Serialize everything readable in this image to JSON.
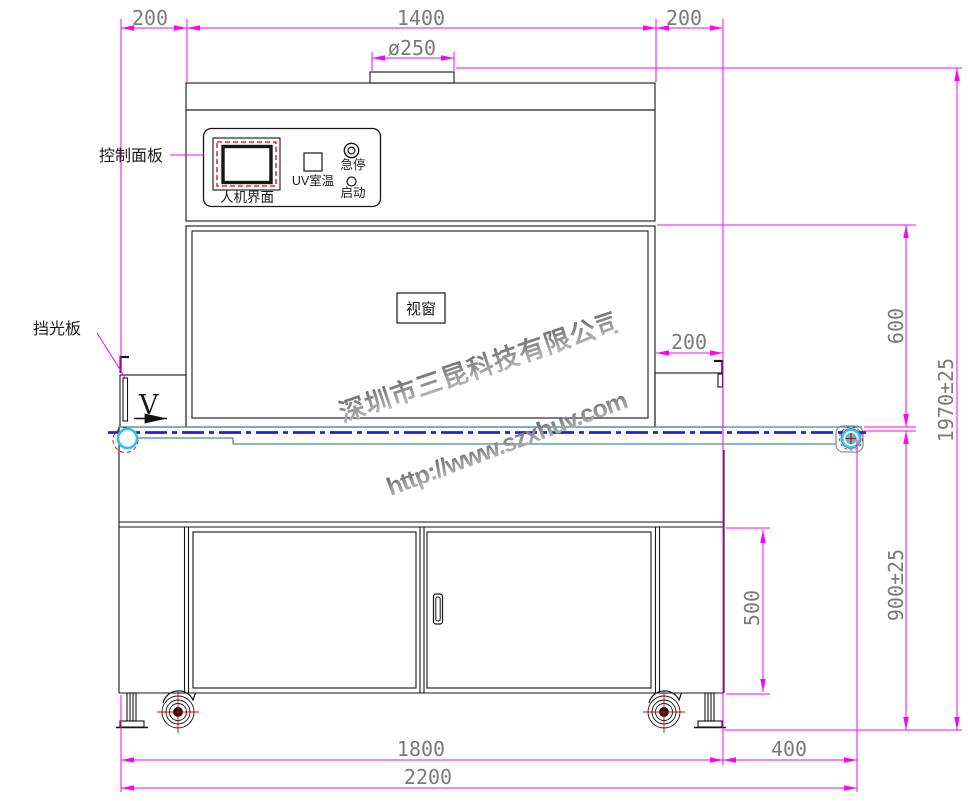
{
  "drawing": {
    "title": "uv-curing-machine-front-view",
    "labels": {
      "control_panel": "控制面板",
      "hmi": "人机界面",
      "uv_temp": "UV室温",
      "emergency_stop": "急停",
      "start": "启动",
      "viewing_window": "视窗",
      "light_shield": "挡光板",
      "belt_direction": "V"
    },
    "dimensions": {
      "top_left_overhang": "200",
      "top_body_width": "1400",
      "top_right_overhang": "200",
      "duct_diameter": "ø250",
      "chamber_height": "600",
      "total_height": "1970±25",
      "right_overhang": "200",
      "door_height": "500",
      "belt_height": "900±25",
      "body_width": "1800",
      "conveyor_extension": "400",
      "total_width": "2200"
    },
    "watermark": {
      "company": "深圳市三昆科技有限公司",
      "url": "http://www.szxhuv.com"
    },
    "colors": {
      "dimension_line": "#ff00ff",
      "dimension_text": "#7a7a7a",
      "outline": "#161616",
      "centerline_blue": "#2020e0",
      "conveyor_teal": "#47889c",
      "roller_cyan": "#3cc9e6",
      "alert_red": "#e00000"
    }
  }
}
